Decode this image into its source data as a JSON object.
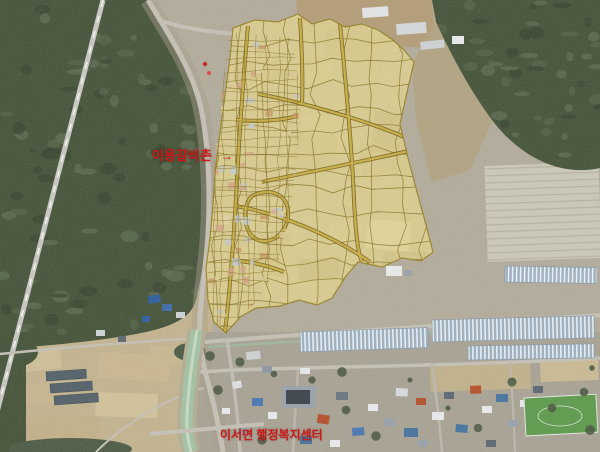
{
  "map": {
    "description": "aerial-photo-with-district-plan-overlay",
    "labels": [
      {
        "text": "이용갈비촌",
        "arrow": "→",
        "x": 152,
        "y": 149
      },
      {
        "text": "이서면 행정복지센터",
        "arrow": "",
        "x": 220,
        "y": 429
      }
    ],
    "colors": {
      "label_red": "#d01616",
      "zone_fill": "#dccf90",
      "zone_outline": "#96801f",
      "parcel_line": "#8a7526",
      "zone_road": "#c9ae45",
      "zone_road_casing": "#6f5e18",
      "forest": "#46543a",
      "forest_dark": "#394630",
      "forest_light": "#55644a",
      "ground": "#b3ac9b",
      "field": "#c3b48f",
      "village_ground": "#a8a394",
      "road": "#c6c1b6",
      "water": "#a3c2a2",
      "greenhouse_base": "#9db1c2",
      "greenhouse_stripe": "#eef2f5"
    },
    "zone": {
      "outline": [
        [
          233,
          28
        ],
        [
          255,
          20
        ],
        [
          278,
          22
        ],
        [
          298,
          14
        ],
        [
          312,
          24
        ],
        [
          330,
          19
        ],
        [
          345,
          27
        ],
        [
          362,
          24
        ],
        [
          378,
          30
        ],
        [
          393,
          40
        ],
        [
          404,
          50
        ],
        [
          414,
          62
        ],
        [
          407,
          92
        ],
        [
          400,
          124
        ],
        [
          408,
          158
        ],
        [
          417,
          192
        ],
        [
          426,
          225
        ],
        [
          433,
          252
        ],
        [
          421,
          261
        ],
        [
          402,
          258
        ],
        [
          382,
          267
        ],
        [
          358,
          262
        ],
        [
          346,
          276
        ],
        [
          332,
          298
        ],
        [
          317,
          305
        ],
        [
          299,
          300
        ],
        [
          280,
          306
        ],
        [
          256,
          308
        ],
        [
          240,
          317
        ],
        [
          226,
          333
        ],
        [
          214,
          322
        ],
        [
          208,
          300
        ],
        [
          206,
          268
        ],
        [
          210,
          238
        ],
        [
          213,
          205
        ],
        [
          215,
          175
        ],
        [
          218,
          148
        ],
        [
          222,
          118
        ],
        [
          226,
          88
        ],
        [
          230,
          58
        ]
      ],
      "village_core": [
        [
          230,
          32
        ],
        [
          292,
          38
        ],
        [
          300,
          90
        ],
        [
          298,
          150
        ],
        [
          290,
          215
        ],
        [
          276,
          270
        ],
        [
          258,
          300
        ],
        [
          240,
          318
        ],
        [
          226,
          331
        ],
        [
          214,
          320
        ],
        [
          208,
          295
        ],
        [
          207,
          260
        ],
        [
          211,
          215
        ],
        [
          214,
          170
        ],
        [
          219,
          120
        ],
        [
          224,
          75
        ]
      ]
    }
  }
}
